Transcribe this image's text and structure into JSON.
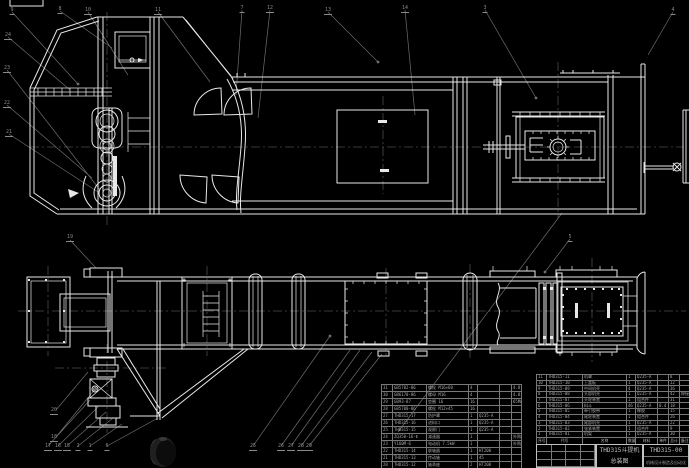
{
  "colors": {
    "background": "#000000",
    "line": "#e8e8e8",
    "leader": "#6e6e6e",
    "centerline": "#4c4c4c",
    "table_line": "#787878",
    "table_text": "#a8a8a8",
    "title_text": "#c0c0c0"
  },
  "title_block": {
    "product_title": "THD315斗提机",
    "drawing_title": "总装图",
    "drawing_number": "THD315-00",
    "organization": "机械设计制造及自动化"
  },
  "bom_right": {
    "header": [
      "序号",
      "代号",
      "名称",
      "数量",
      "材料",
      "单件",
      "总计",
      "备注"
    ],
    "rows": [
      {
        "seq": "11",
        "code": "THD315-11",
        "name": "机罩",
        "qty": "1",
        "material": "Q235-A",
        "w1": "",
        "w2": "8",
        "note": ""
      },
      {
        "seq": "10",
        "code": "THD315-10",
        "name": "上盖板",
        "qty": "1",
        "material": "Q235-A",
        "w1": "",
        "w2": "12",
        "note": ""
      },
      {
        "seq": "9",
        "code": "THD315-09",
        "name": "中间机壳",
        "qty": "4",
        "material": "Q235-A",
        "w1": "",
        "w2": "36",
        "note": ""
      },
      {
        "seq": "8",
        "code": "THD315-08",
        "name": "头部机壳",
        "qty": "1",
        "material": "Q235-A",
        "w1": "",
        "w2": "42",
        "note": "焊接件"
      },
      {
        "seq": "7",
        "code": "THD315-07",
        "name": "头轮装置",
        "qty": "1",
        "material": "组合件",
        "w1": "",
        "w2": "31",
        "note": ""
      },
      {
        "seq": "6",
        "code": "THD315-06",
        "name": "料斗",
        "qty": "46",
        "material": "Q235-A",
        "w1": "0.4",
        "w2": "18",
        "note": ""
      },
      {
        "seq": "5",
        "code": "THD315-05",
        "name": "牵引胶带",
        "qty": "1",
        "material": "橡胶",
        "w1": "",
        "w2": "15",
        "note": ""
      },
      {
        "seq": "4",
        "code": "THD315-04",
        "name": "尾轮装置",
        "qty": "1",
        "material": "组合件",
        "w1": "",
        "w2": "26",
        "note": ""
      },
      {
        "seq": "3",
        "code": "THD315-03",
        "name": "尾部机壳",
        "qty": "1",
        "material": "Q235-A",
        "w1": "",
        "w2": "22",
        "note": ""
      },
      {
        "seq": "2",
        "code": "THD315-02",
        "name": "张紧装置",
        "qty": "1",
        "material": "组合件",
        "w1": "",
        "w2": "9",
        "note": ""
      },
      {
        "seq": "1",
        "code": "THD315-01",
        "name": "机架",
        "qty": "1",
        "material": "Q235-A",
        "w1": "",
        "w2": "30",
        "note": ""
      }
    ]
  },
  "bom_left": {
    "rows": [
      {
        "seq": "31",
        "code": "GB5782-86",
        "name": "螺栓 M16×60",
        "qty": "4",
        "material": "",
        "weight": "",
        "note": "4.8"
      },
      {
        "seq": "30",
        "code": "GB6170-86",
        "name": "螺母 M16",
        "qty": "4",
        "material": "",
        "weight": "",
        "note": "4.8"
      },
      {
        "seq": "29",
        "code": "GB93-87",
        "name": "垫圈 16",
        "qty": "16",
        "material": "",
        "weight": "",
        "note": "65Mn"
      },
      {
        "seq": "28",
        "code": "GB5780-86",
        "name": "螺栓 M12×45",
        "qty": "16",
        "material": "",
        "weight": "",
        "note": ""
      },
      {
        "seq": "27",
        "code": "THD315-17",
        "name": "防护罩",
        "qty": "1",
        "material": "Q235-A",
        "weight": "",
        "note": ""
      },
      {
        "seq": "26",
        "code": "THD315-16",
        "name": "进料口",
        "qty": "1",
        "material": "Q235-A",
        "weight": "",
        "note": ""
      },
      {
        "seq": "25",
        "code": "THD315-15",
        "name": "观察门",
        "qty": "1",
        "material": "Q235-A",
        "weight": "",
        "note": ""
      },
      {
        "seq": "24",
        "code": "ZQ350-16-Ⅱ",
        "name": "减速器",
        "qty": "1",
        "material": "",
        "weight": "",
        "note": "外购"
      },
      {
        "seq": "23",
        "code": "Y160M-6",
        "name": "电动机 7.5kW",
        "qty": "1",
        "material": "",
        "weight": "",
        "note": "外购"
      },
      {
        "seq": "22",
        "code": "THD315-14",
        "name": "联轴器",
        "qty": "1",
        "material": "HT200",
        "weight": "",
        "note": ""
      },
      {
        "seq": "21",
        "code": "THD315-13",
        "name": "传动轴",
        "qty": "1",
        "material": "45",
        "weight": "",
        "note": ""
      },
      {
        "seq": "20",
        "code": "THD315-12",
        "name": "轴承座",
        "qty": "2",
        "material": "HT200",
        "weight": "",
        "note": ""
      }
    ]
  },
  "balloons": [
    {
      "x": 12,
      "y": 8,
      "n": "9"
    },
    {
      "x": 60,
      "y": 7,
      "n": "8"
    },
    {
      "x": 88,
      "y": 8,
      "n": "10"
    },
    {
      "x": 158,
      "y": 8,
      "n": "11"
    },
    {
      "x": 242,
      "y": 6,
      "n": "7"
    },
    {
      "x": 270,
      "y": 6,
      "n": "12"
    },
    {
      "x": 328,
      "y": 8,
      "n": "13"
    },
    {
      "x": 405,
      "y": 6,
      "n": "14"
    },
    {
      "x": 485,
      "y": 6,
      "n": "3"
    },
    {
      "x": 673,
      "y": 8,
      "n": "4"
    },
    {
      "x": 8,
      "y": 33,
      "n": "24"
    },
    {
      "x": 7,
      "y": 66,
      "n": "23"
    },
    {
      "x": 7,
      "y": 101,
      "n": "22"
    },
    {
      "x": 9,
      "y": 130,
      "n": "21"
    },
    {
      "x": 70,
      "y": 235,
      "n": "19"
    },
    {
      "x": 570,
      "y": 235,
      "n": "5"
    },
    {
      "x": 54,
      "y": 408,
      "n": "20"
    },
    {
      "x": 54,
      "y": 435,
      "n": "18"
    },
    {
      "x": 48,
      "y": 444,
      "n": "17"
    },
    {
      "x": 58,
      "y": 444,
      "n": "16"
    },
    {
      "x": 67,
      "y": 444,
      "n": "15"
    },
    {
      "x": 78,
      "y": 444,
      "n": "2"
    },
    {
      "x": 90,
      "y": 444,
      "n": "1"
    },
    {
      "x": 107,
      "y": 444,
      "n": "6"
    },
    {
      "x": 253,
      "y": 444,
      "n": "25"
    },
    {
      "x": 281,
      "y": 444,
      "n": "26"
    },
    {
      "x": 291,
      "y": 444,
      "n": "27"
    },
    {
      "x": 301,
      "y": 444,
      "n": "28"
    },
    {
      "x": 309,
      "y": 444,
      "n": "29"
    }
  ],
  "watermark": {
    "shape": "dark-sphere-logo"
  }
}
